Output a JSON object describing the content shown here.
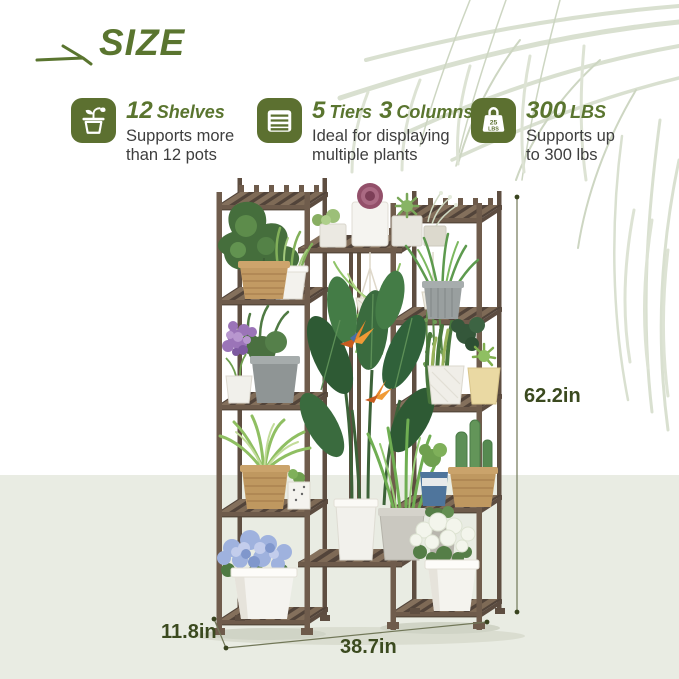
{
  "header": {
    "title": "SIZE"
  },
  "features": [
    {
      "number": "12",
      "label": "Shelves",
      "description_line1": "Supports more",
      "description_line2": "than 12 pots",
      "icon": "potted-plant-icon"
    },
    {
      "number": "5",
      "label": "Tiers",
      "number2": "3",
      "label2": "Columns",
      "description_line1": "Ideal for displaying",
      "description_line2": "multiple plants",
      "icon": "shelf-tiers-icon"
    },
    {
      "number": "300",
      "label": "LBS",
      "description_line1": "Supports up",
      "description_line2": "to 300 lbs",
      "icon": "weight-icon"
    }
  ],
  "weight_icon_text": {
    "top": "25",
    "bottom": "LBS"
  },
  "dimensions": {
    "height_label": "62.2in",
    "width_label": "38.7in",
    "depth_label": "11.8in"
  },
  "colors": {
    "accent_green": "#5a752f",
    "dimension_green": "#3b4a1f",
    "icon_background": "#5c7030",
    "wood_brown": "#6e5b4b",
    "floor": "#e9ece3",
    "palm_frond": "#d9e0d0"
  }
}
